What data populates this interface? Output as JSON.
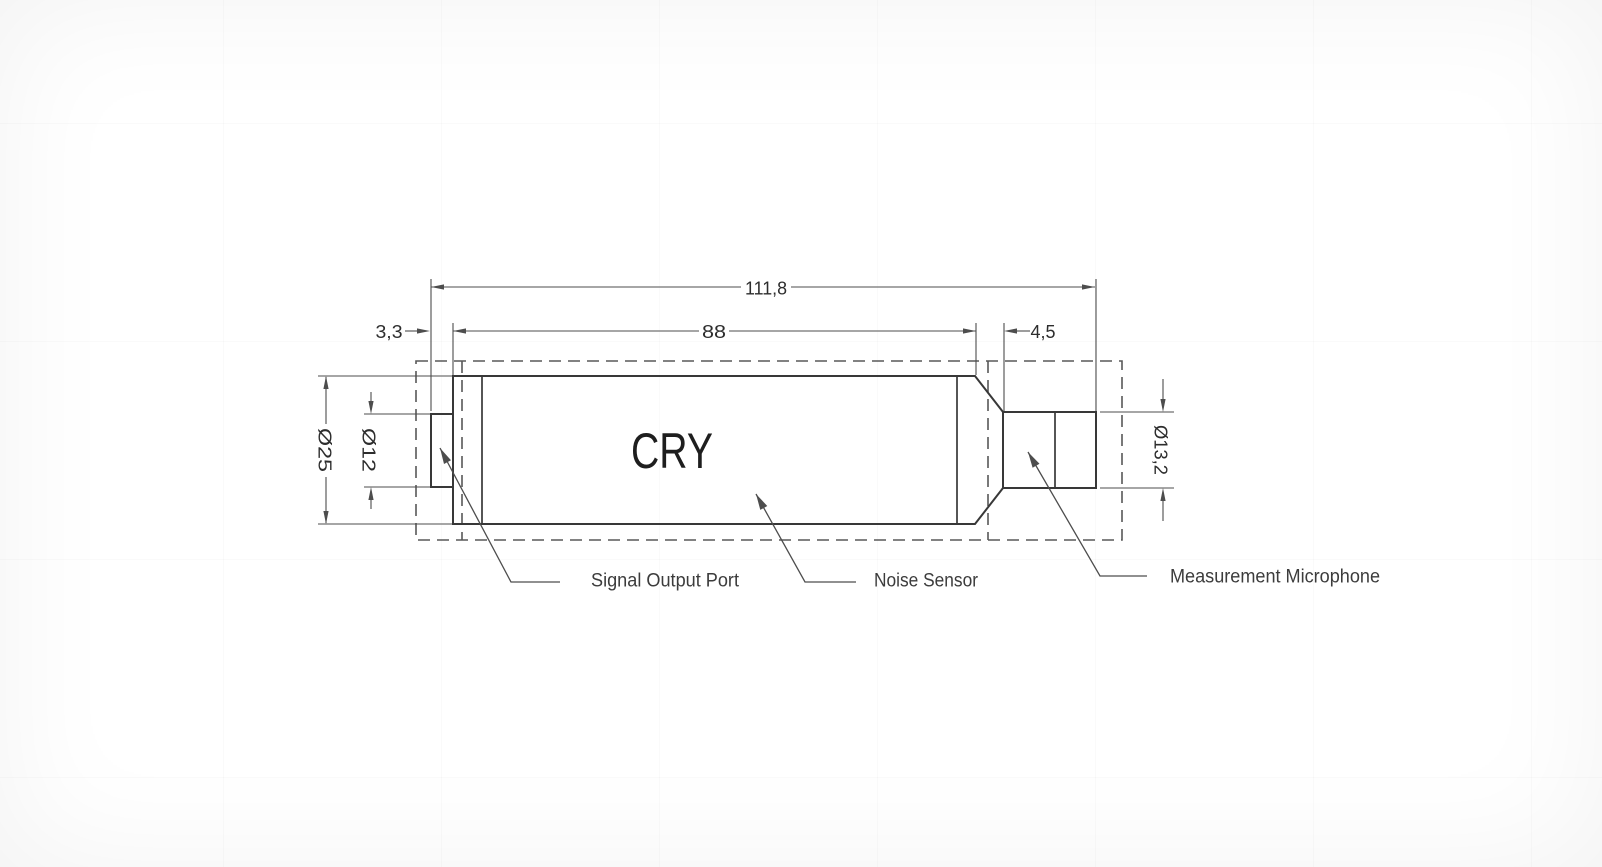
{
  "drawing": {
    "brand": "CRY",
    "dimensions": {
      "total_length": "111,8",
      "body_length": "88",
      "connector_offset": "3,3",
      "taper_length": "4,5",
      "body_diameter": "Ø25",
      "connector_diameter": "Ø12",
      "microphone_diameter": "Ø13,2"
    },
    "callouts": {
      "signal_output_port": "Signal Output Port",
      "noise_sensor": "Noise Sensor",
      "measurement_microphone": "Measurement Microphone"
    },
    "colors": {
      "background": "#ffffff",
      "geometry_line": "#383838",
      "dashed_line": "#585858",
      "dimension_line": "#4d4d4d",
      "dimension_text": "#2d2d2d",
      "callout_text": "#3c3c3c",
      "brand_text": "#1e1e1e"
    }
  }
}
